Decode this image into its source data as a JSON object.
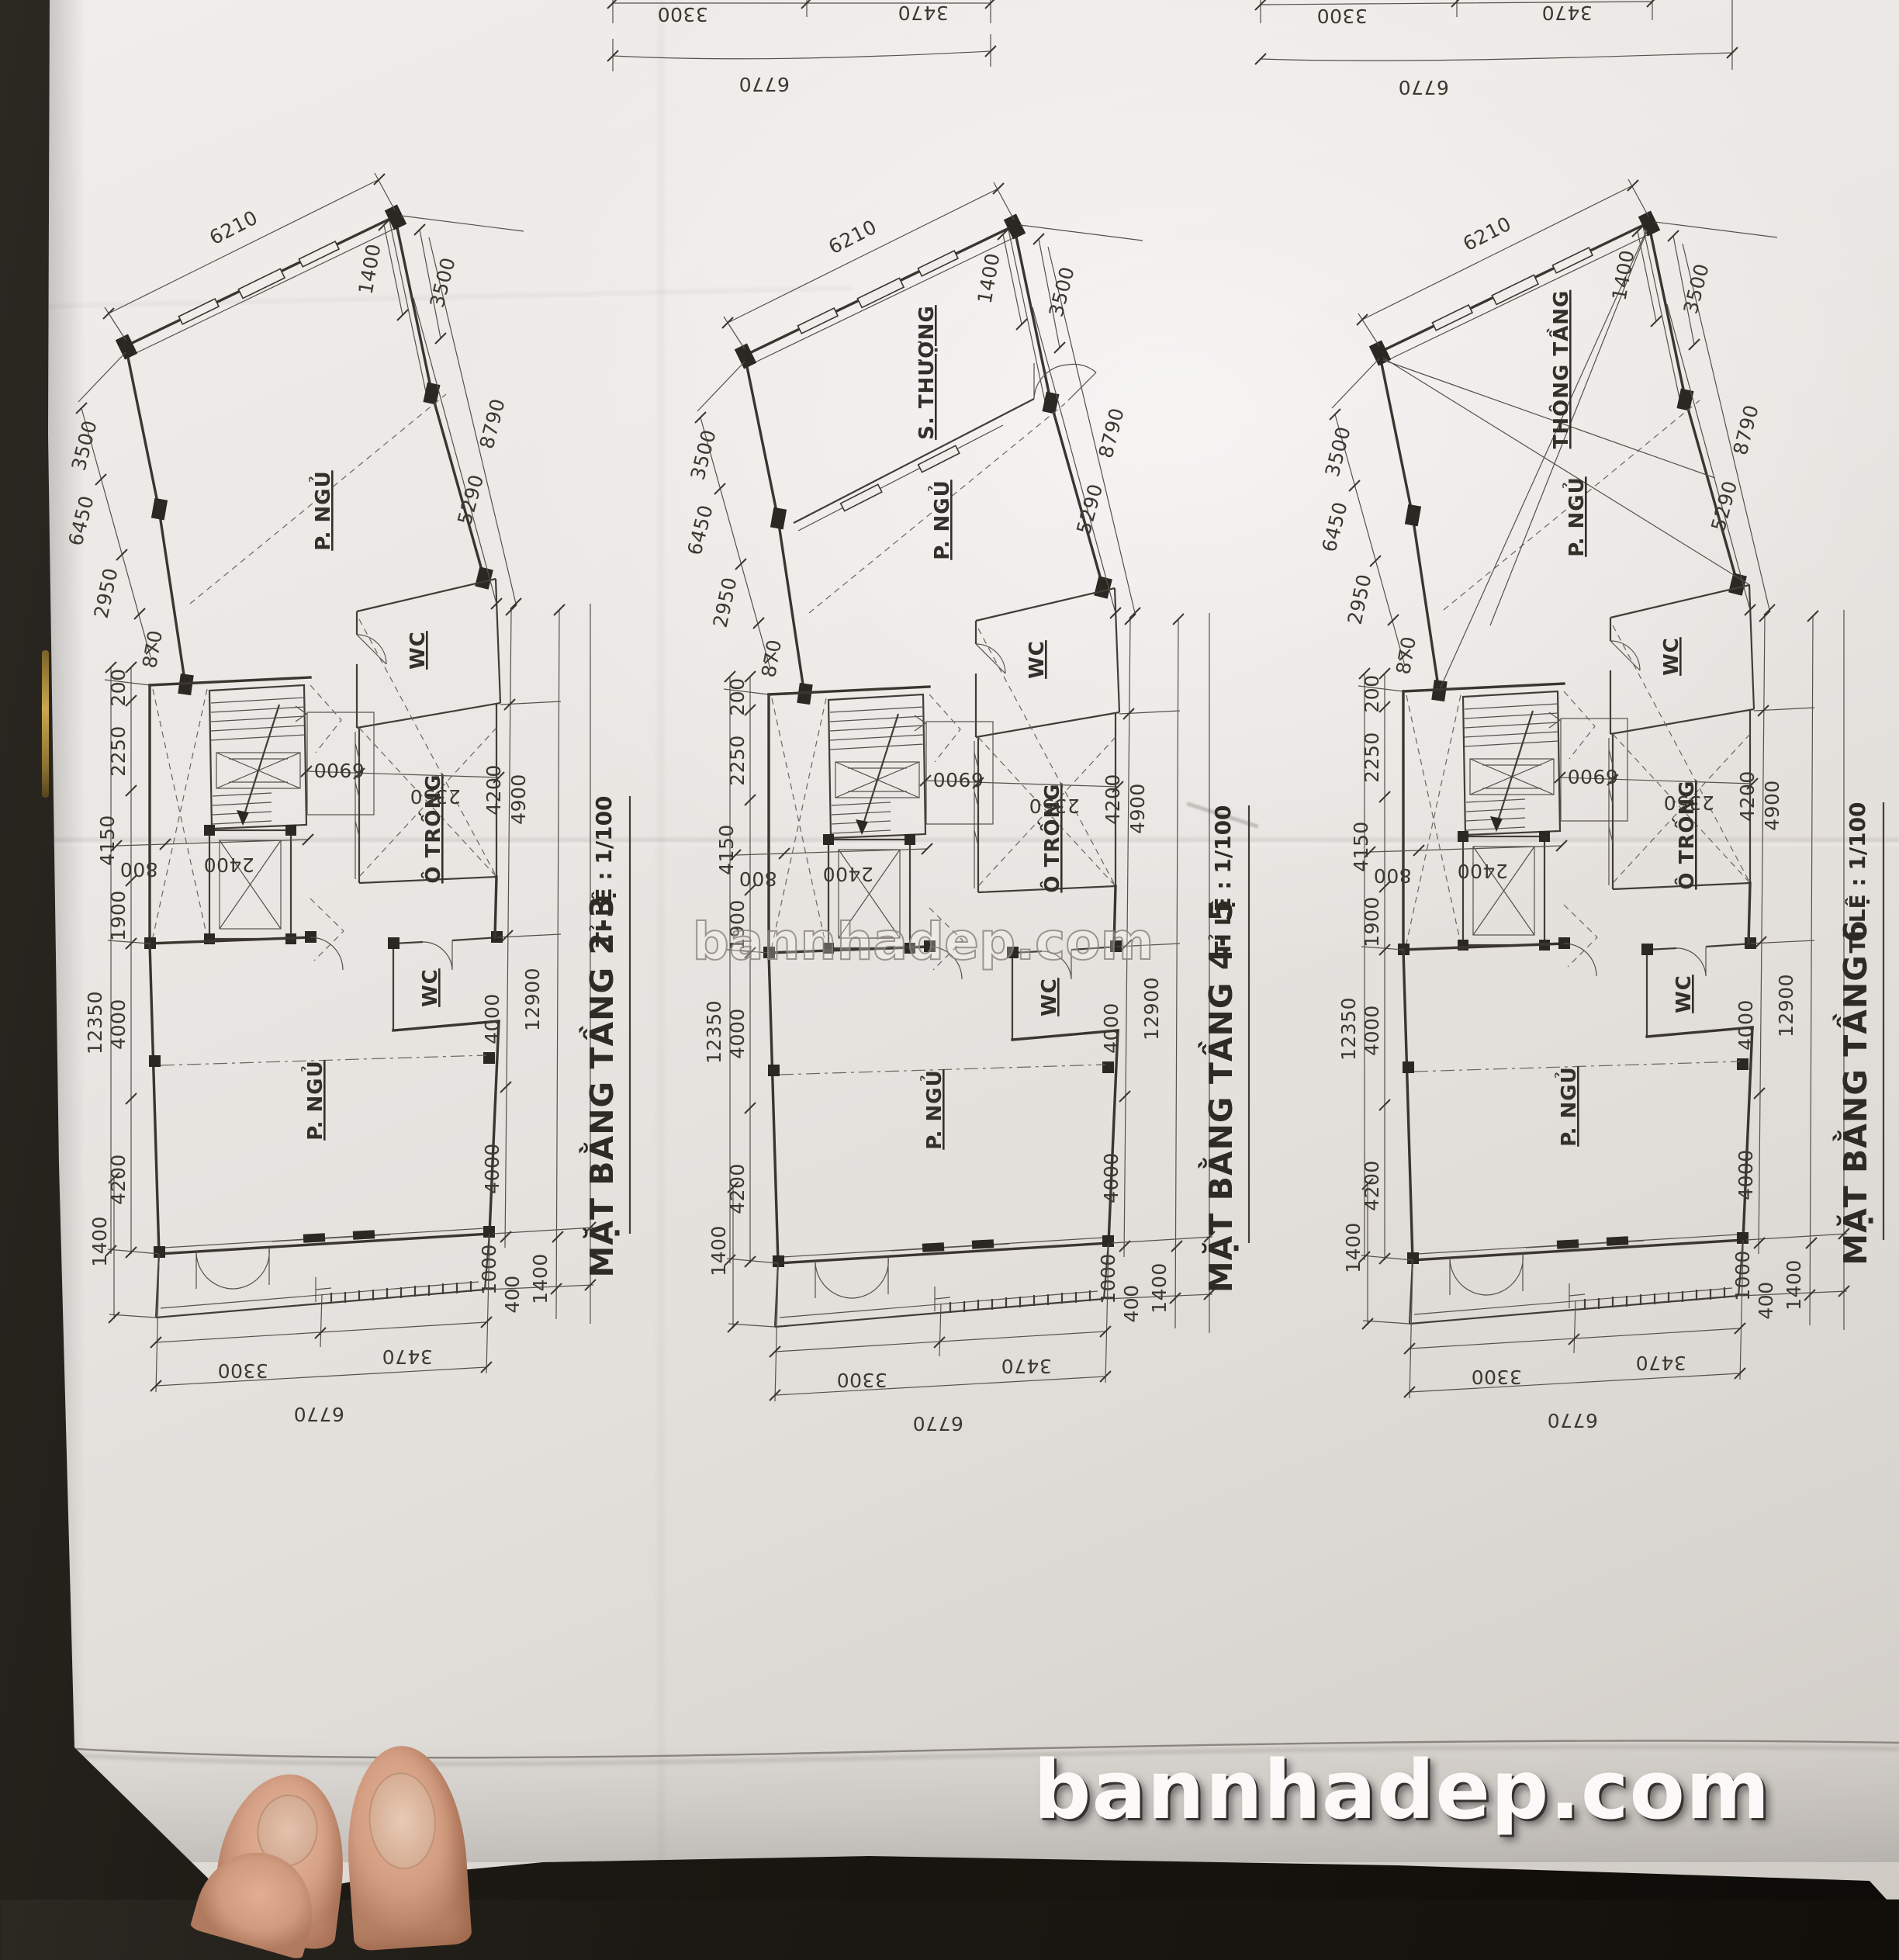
{
  "page": {
    "center_watermark": "bannhadep.com",
    "bottom_watermark": "bannhadep.com"
  },
  "top_chain": {
    "seg1": "3300",
    "seg2": "3470",
    "total": "6770"
  },
  "plans": [
    {
      "title": "MẶT BẰNG TẦNG 2-3",
      "scale_label": "TỈ LỆ : 1/100",
      "variant": "upper-dashed",
      "rooms": {
        "slotA": "",
        "slotB": "P. NGỦ",
        "lower": "P. NGỦ",
        "wc_upper": "WC",
        "wc_lower": "WC",
        "void": "Ô TRỐNG"
      },
      "dims": {
        "d6210": "6210",
        "d1400_top": "1400",
        "d3500_r": "3500",
        "d8790": "8790",
        "d5290": "5290",
        "d3500_l": "3500",
        "d6450": "6450",
        "d2950": "2950",
        "d870": "870",
        "d200": "200",
        "d2250": "2250",
        "d4150": "4150",
        "d1900": "1900",
        "d12350": "12350",
        "d4000_l1": "4000",
        "d4200_l": "4200",
        "d1400_bl": "1400",
        "d6900": "6900",
        "d2350": "2350",
        "d4200_r": "4200",
        "d4900": "4900",
        "d4000_r1": "4000",
        "d12900": "12900",
        "d4000_r2": "4000",
        "d1000": "1000",
        "d400": "400",
        "d1400_br": "1400",
        "d800": "800",
        "d2400": "2400",
        "d3300": "3300",
        "d3470": "3470",
        "d6770": "6770"
      }
    },
    {
      "title": "MẶT BẰNG TẦNG 4- 5",
      "scale_label": "TỈ LỆ : 1/100",
      "variant": "terrace-door",
      "rooms": {
        "slotA": "S. THƯỢNG",
        "slotB": "P. NGỦ",
        "lower": "P. NGỦ",
        "wc_upper": "WC",
        "wc_lower": "WC",
        "void": "Ô TRỐNG"
      },
      "dims": {
        "d6210": "6210",
        "d1400_top": "1400",
        "d3500_r": "3500",
        "d8790": "8790",
        "d5290": "5290",
        "d3500_l": "3500",
        "d6450": "6450",
        "d2950": "2950",
        "d870": "870",
        "d200": "200",
        "d2250": "2250",
        "d4150": "4150",
        "d1900": "1900",
        "d12350": "12350",
        "d4000_l1": "4000",
        "d4200_l": "4200",
        "d1400_bl": "1400",
        "d6900": "6900",
        "d2350": "2350",
        "d4200_r": "4200",
        "d4900": "4900",
        "d4000_r1": "4000",
        "d12900": "12900",
        "d4000_r2": "4000",
        "d1000": "1000",
        "d400": "400",
        "d1400_br": "1400",
        "d800": "800",
        "d2400": "2400",
        "d3300": "3300",
        "d3470": "3470",
        "d6770": "6770"
      }
    },
    {
      "title": "MẶT BẰNG TẦNG 6",
      "scale_label": "TỈ LỆ : 1/100",
      "variant": "void-cross",
      "rooms": {
        "slotA": "THÔNG TẦNG",
        "slotB": "P. NGỦ",
        "lower": "P. NGỦ",
        "wc_upper": "WC",
        "wc_lower": "WC",
        "void": "Ô TRỐNG"
      },
      "dims": {
        "d6210": "6210",
        "d1400_top": "1400",
        "d3500_r": "3500",
        "d8790": "8790",
        "d5290": "5290",
        "d3500_l": "3500",
        "d6450": "6450",
        "d2950": "2950",
        "d870": "870",
        "d200": "200",
        "d2250": "2250",
        "d4150": "4150",
        "d1900": "1900",
        "d12350": "12350",
        "d4000_l1": "4000",
        "d4200_l": "4200",
        "d1400_bl": "1400",
        "d6900": "6900",
        "d2350": "2350",
        "d4200_r": "4200",
        "d4900": "4900",
        "d4000_r1": "4000",
        "d12900": "12900",
        "d4000_r2": "4000",
        "d1000": "1000",
        "d400": "400",
        "d1400_br": "1400",
        "d800": "800",
        "d2400": "2400",
        "d3300": "3300",
        "d3470": "3470",
        "d6770": "6770"
      }
    }
  ]
}
